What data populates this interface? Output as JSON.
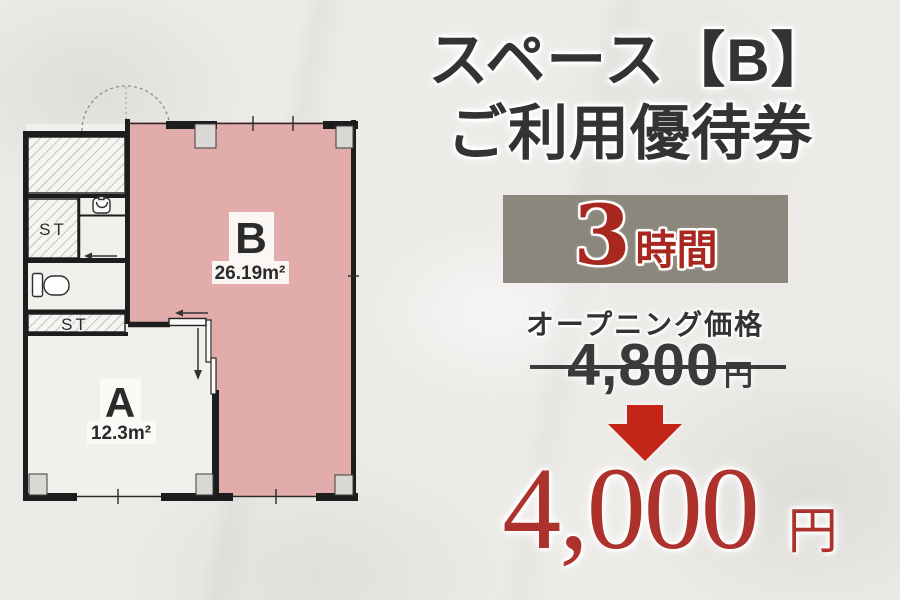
{
  "palette": {
    "background": "#edebe8",
    "text_dark": "#333333",
    "badge_background": "#8b877c",
    "badge_text_red": "#a8271f",
    "arrow_red": "#c32619",
    "new_price_red": "#ad322c",
    "space_b_fill": "#e1acaa",
    "wall_color": "#1d1d1d"
  },
  "offer": {
    "title_line1": "スペース【B】",
    "title_line2": "ご利用優待券",
    "duration_number": "3",
    "duration_unit": "時間",
    "price_label": "オープニング価格",
    "old_price": "4,800",
    "old_price_unit": "円",
    "new_price": "4,000",
    "new_price_unit": "円"
  },
  "floor_plan": {
    "space_b_label": "B",
    "space_b_area": "26.19m²",
    "space_a_label": "A",
    "space_a_area": "12.3m²",
    "storage_top_label": "ST",
    "storage_bottom_label": "ST"
  },
  "icons": [
    "down-arrow-icon",
    "sink-icon",
    "toilet-icon",
    "door-swing-arc-icon",
    "arrow-left-icon",
    "arrow-down-icon"
  ]
}
